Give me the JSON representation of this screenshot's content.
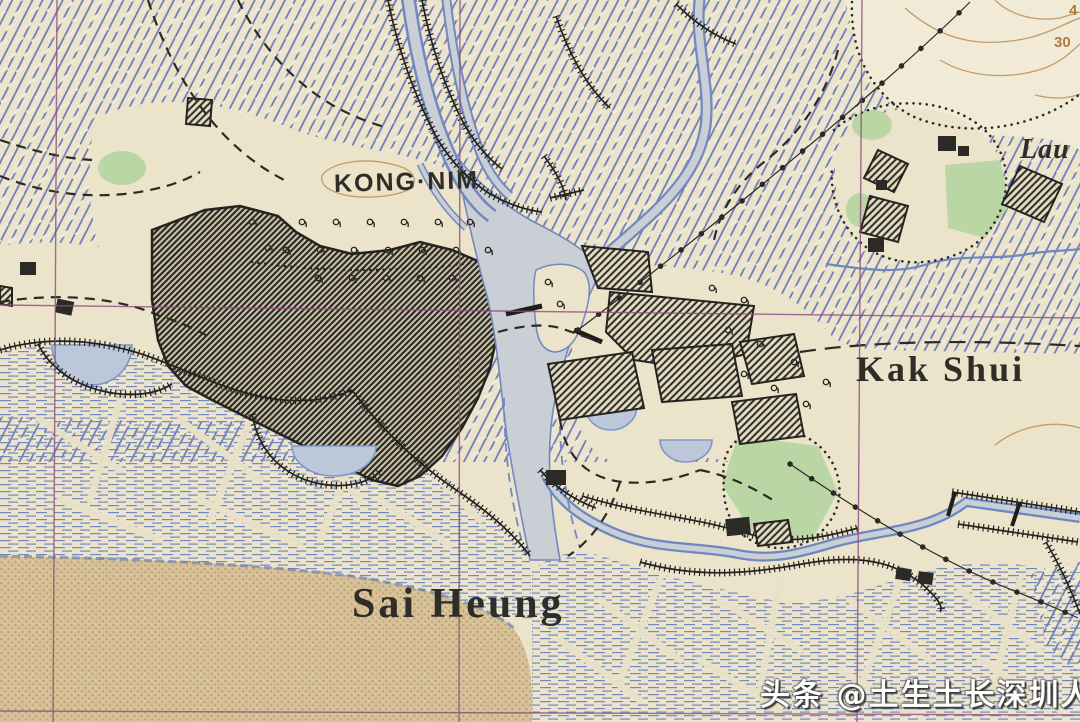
{
  "map": {
    "labels": {
      "kong_nim": "KONG·NIM",
      "kak_shui": "Kak Shui",
      "sai_heung": "Sai Heung",
      "lau_partial": "Lau",
      "contour_upper": "4",
      "contour_lower": "30"
    },
    "watermark": "头条 @土生土长深圳人",
    "colors": {
      "paper_cream": "#ece4ca",
      "grid_magenta": "#8d4b7c",
      "ink_black": "#2f2d28",
      "contour_brown": "#b07a45",
      "paddy_blue": "#6678ba",
      "water_fill": "#c9cfd4",
      "water_edge": "#7288c0",
      "pond_fill": "#bcc8da",
      "vegetation_green": "#b9d6a4",
      "sand_brown": "#d5c098"
    }
  }
}
